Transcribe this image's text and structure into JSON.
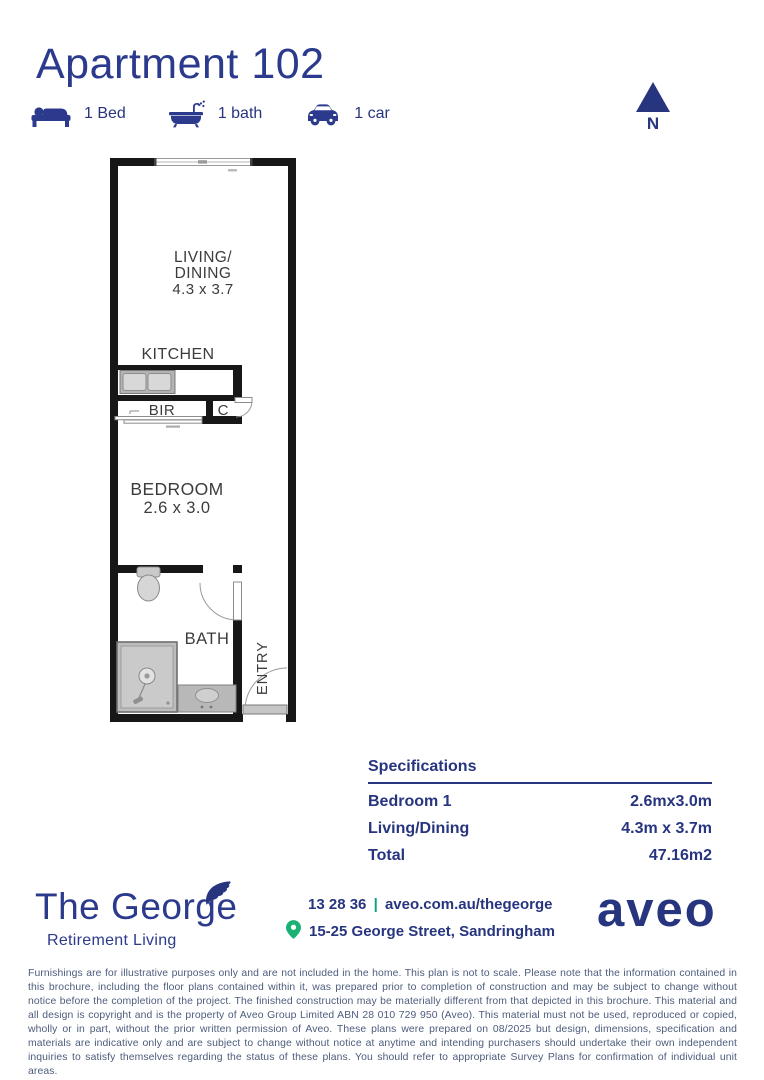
{
  "page": {
    "title": "Apartment 102"
  },
  "features": [
    {
      "icon": "bed-icon",
      "label": "1 Bed"
    },
    {
      "icon": "bath-icon",
      "label": "1 bath"
    },
    {
      "icon": "car-icon",
      "label": "1 car"
    }
  ],
  "compass": {
    "label": "N"
  },
  "plan": {
    "living_line1": "LIVING/",
    "living_line2": "DINING",
    "living_dims": "4.3 x 3.7",
    "kitchen": "KITCHEN",
    "bir": "BIR",
    "cupboard": "C",
    "bedroom": "BEDROOM",
    "bedroom_dims": "2.6 x 3.0",
    "bath": "BATH",
    "entry": "ENTRY"
  },
  "specs": {
    "title": "Specifications",
    "rows": [
      {
        "label": "Bedroom 1",
        "value": "2.6mx3.0m"
      },
      {
        "label": "Living/Dining",
        "value": "4.3m x 3.7m"
      },
      {
        "label": "Total",
        "value": "47.16m2"
      }
    ]
  },
  "footer": {
    "brand": {
      "name": "The George",
      "tagline": "Retirement Living"
    },
    "contact": {
      "phone": "13 28 36",
      "separator": "|",
      "website": "aveo.com.au/thegeorge",
      "address": "15-25 George Street, Sandringham"
    },
    "logo": "aveo"
  },
  "disclaimer": "Furnishings are for illustrative purposes only and are not included in the home. This plan is not to scale. Please note that the information contained in this brochure, including the floor plans contained within it, was prepared prior to completion of construction and may be subject to change without notice before the completion of the project. The finished construction may be materially different from that depicted in this brochure. This material and all design is copyright and is the property of Aveo Group Limited ABN 28 010 729 950 (Aveo). This material must not be used, reproduced or copied, wholly or in part, without the prior written permission of Aveo. These plans were prepared on 08/2025 but design, dimensions, specification and materials are indicative only and are subject to change without notice at anytime and intending purchasers should undertake their own independent inquiries to satisfy themselves regarding the status of these plans. You should refer to appropriate Survey Plans for confirmation of individual unit areas.",
  "colors": {
    "navy": "#2b3a8c",
    "green_pin": "#19b274",
    "teal_separator": "#0ca183",
    "wall": "#171717",
    "disclaimer_text": "#4d5c7c"
  }
}
